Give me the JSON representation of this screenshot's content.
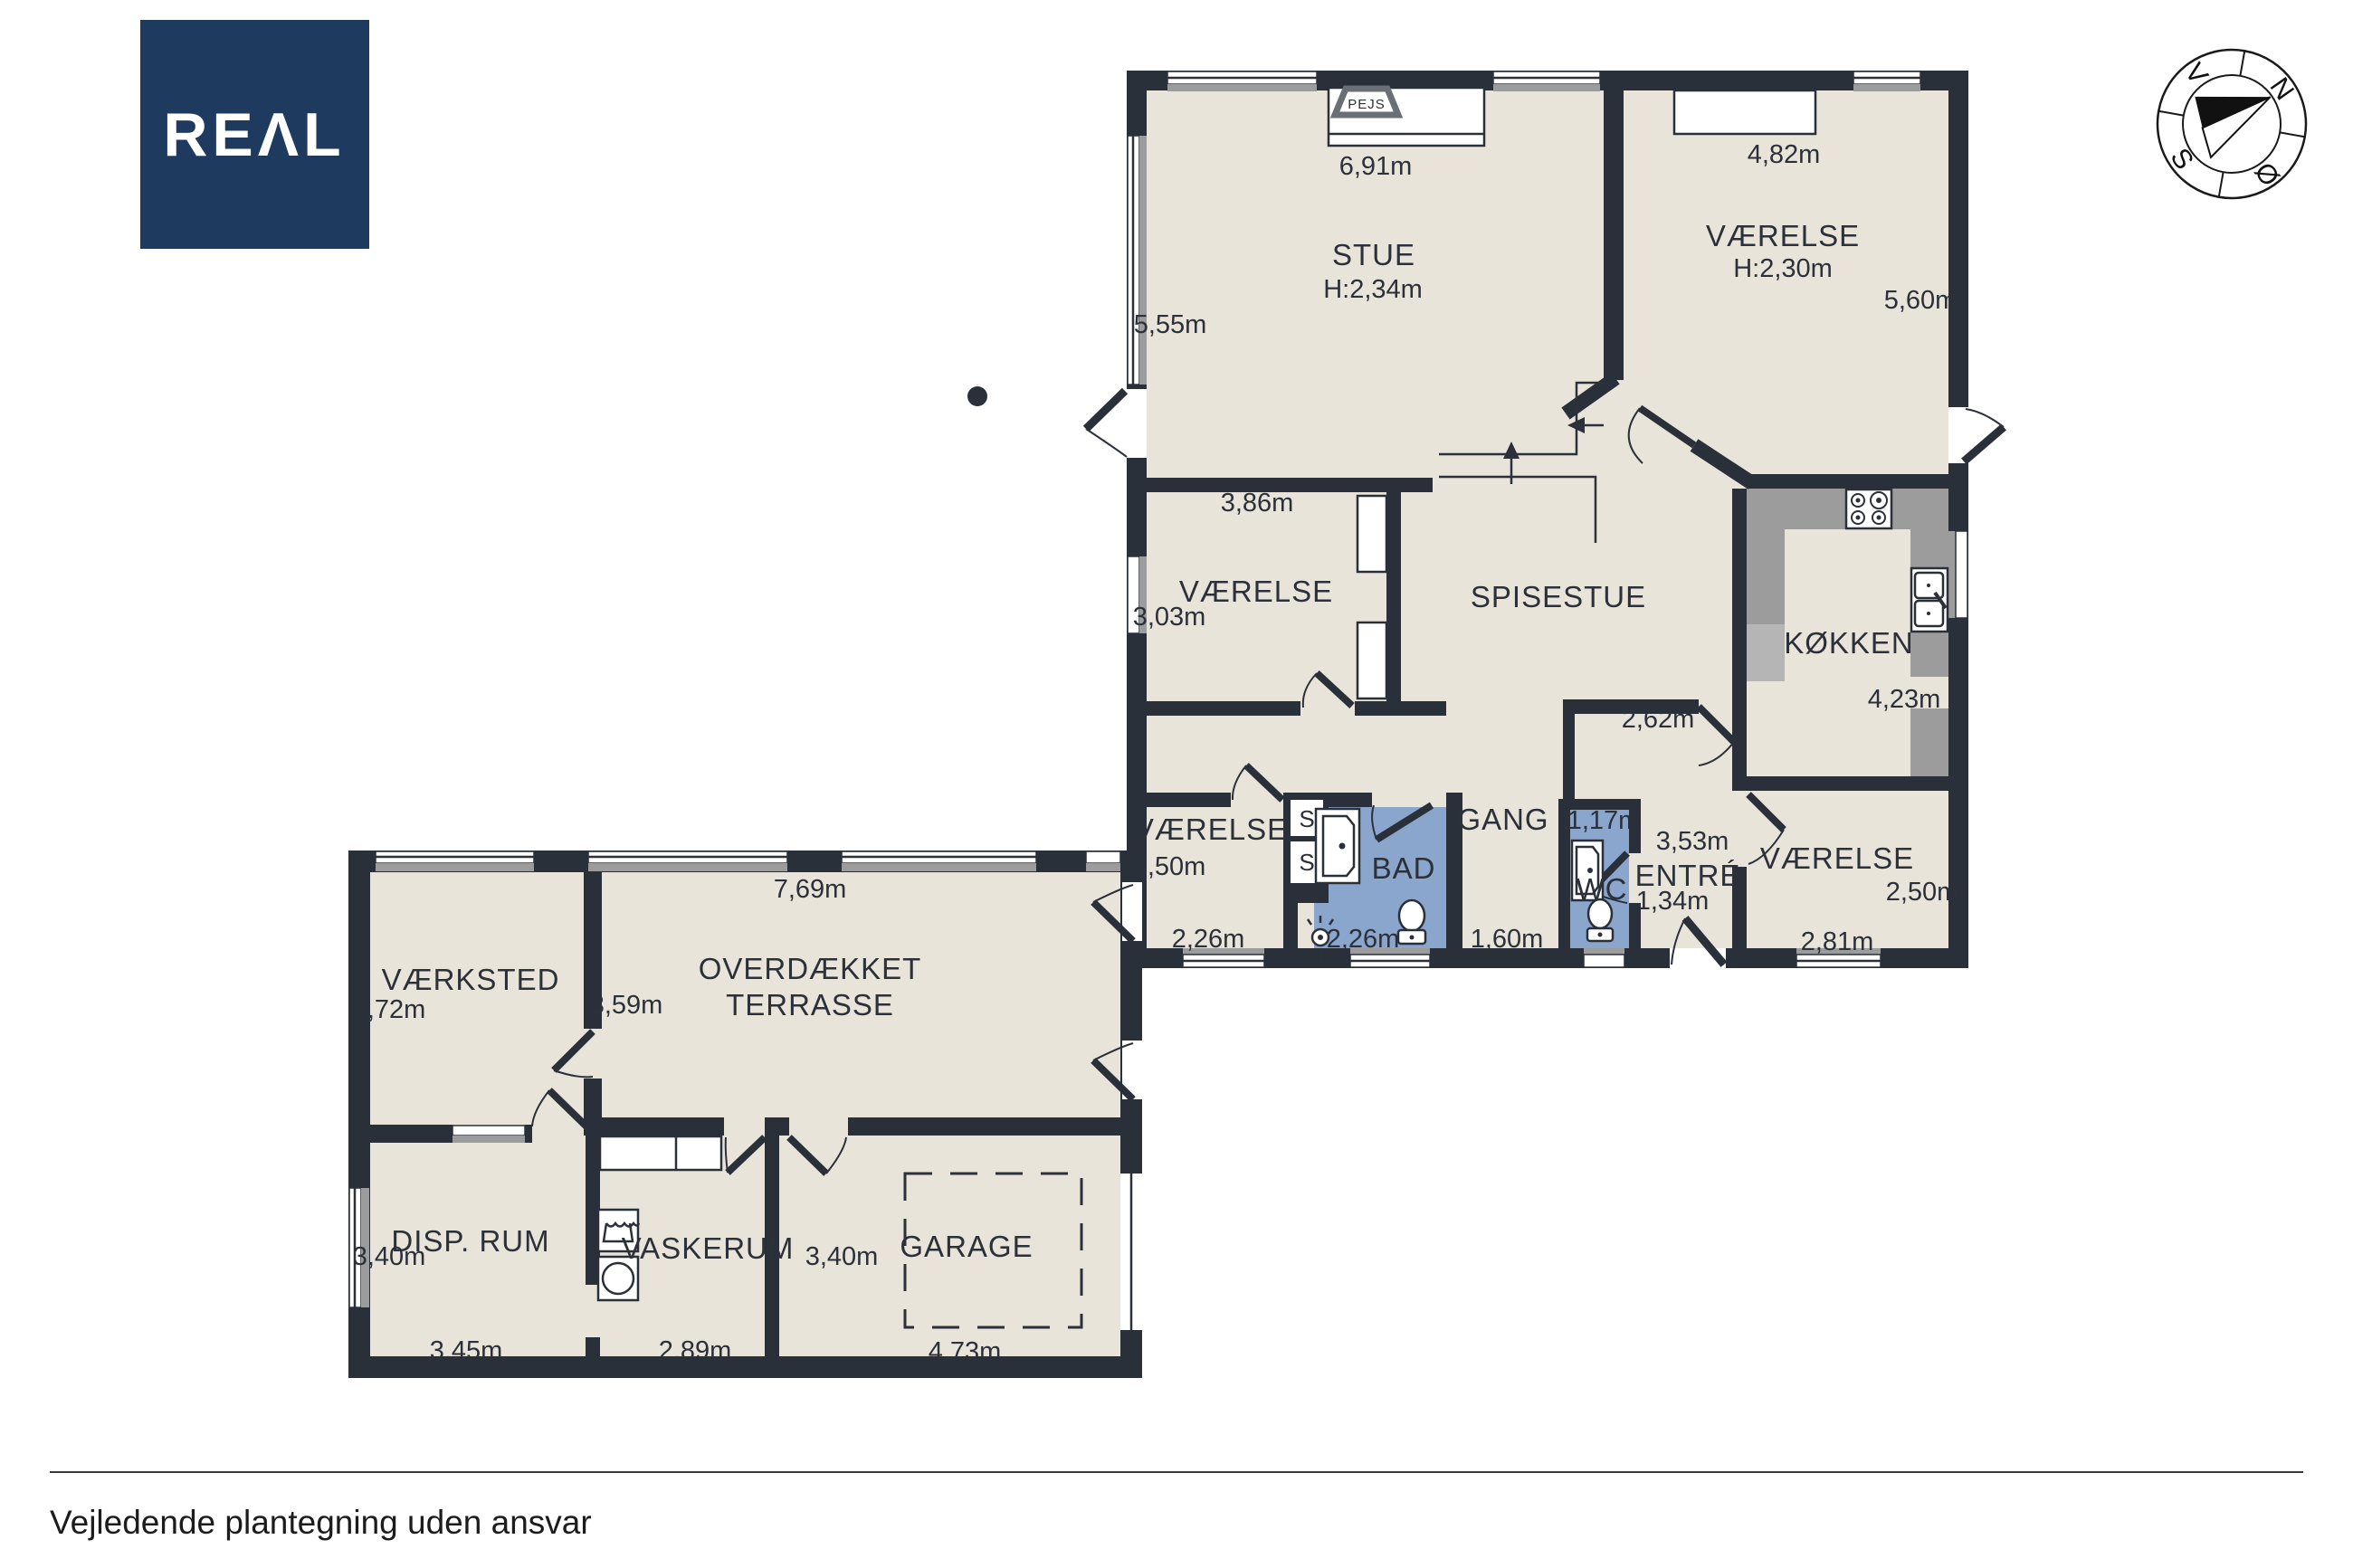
{
  "logo": {
    "text": "REAL"
  },
  "compass": {
    "n": "N",
    "e": "Ø",
    "s": "S",
    "w": "V"
  },
  "rooms": {
    "stue": {
      "name": "STUE",
      "ceiling": "H:2,34m",
      "w": "6,91m",
      "h": "5,55m"
    },
    "vaerelse_ne": {
      "name": "VÆRELSE",
      "ceiling": "H:2,30m",
      "w": "4,82m",
      "h": "5,60m"
    },
    "vaerelse_mid": {
      "name": "VÆRELSE",
      "w": "3,86m",
      "h": "3,03m"
    },
    "spisestue": {
      "name": "SPISESTUE",
      "nook_w": "2,62m"
    },
    "koekken": {
      "name": "KØKKEN",
      "h": "4,23m"
    },
    "vaerelse_sv": {
      "name": "VÆRELSE",
      "h": "3,50m",
      "w": "2,26m"
    },
    "bad": {
      "name": "BAD",
      "w": "2,26m"
    },
    "gang": {
      "name": "GANG",
      "w": "1,60m"
    },
    "wc": {
      "name": "WC",
      "w": "1,17m"
    },
    "entre": {
      "name": "ENTRÉ",
      "w1": "3,53m",
      "w2": "1,34m"
    },
    "vaerelse_se": {
      "name": "VÆRELSE",
      "h": "2,50m",
      "w": "2,81m"
    },
    "vaerksted": {
      "name": "VÆRKSTED",
      "h": "3,72m"
    },
    "terrasse": {
      "name1": "OVERDÆKKET",
      "name2": "TERRASSE",
      "w": "7,69m",
      "h": "3,59m"
    },
    "disp_rum": {
      "name": "DISP. RUM",
      "h": "3,40m",
      "w": "3,45m"
    },
    "vaskerum": {
      "name": "VASKERUM",
      "w": "2,89m"
    },
    "garage": {
      "name": "GARAGE",
      "h": "3,40m",
      "w": "4,73m"
    }
  },
  "fixtures": {
    "fireplace": "PEJS",
    "closet1": "S",
    "closet2": "S"
  },
  "footer": {
    "disclaimer": "Vejledende plantegning uden ansvar"
  },
  "colors": {
    "wall": "#2a303a",
    "floor": "#e8e4da",
    "wet_room": "#8aa6cc",
    "logo": "#1e3a5f"
  }
}
